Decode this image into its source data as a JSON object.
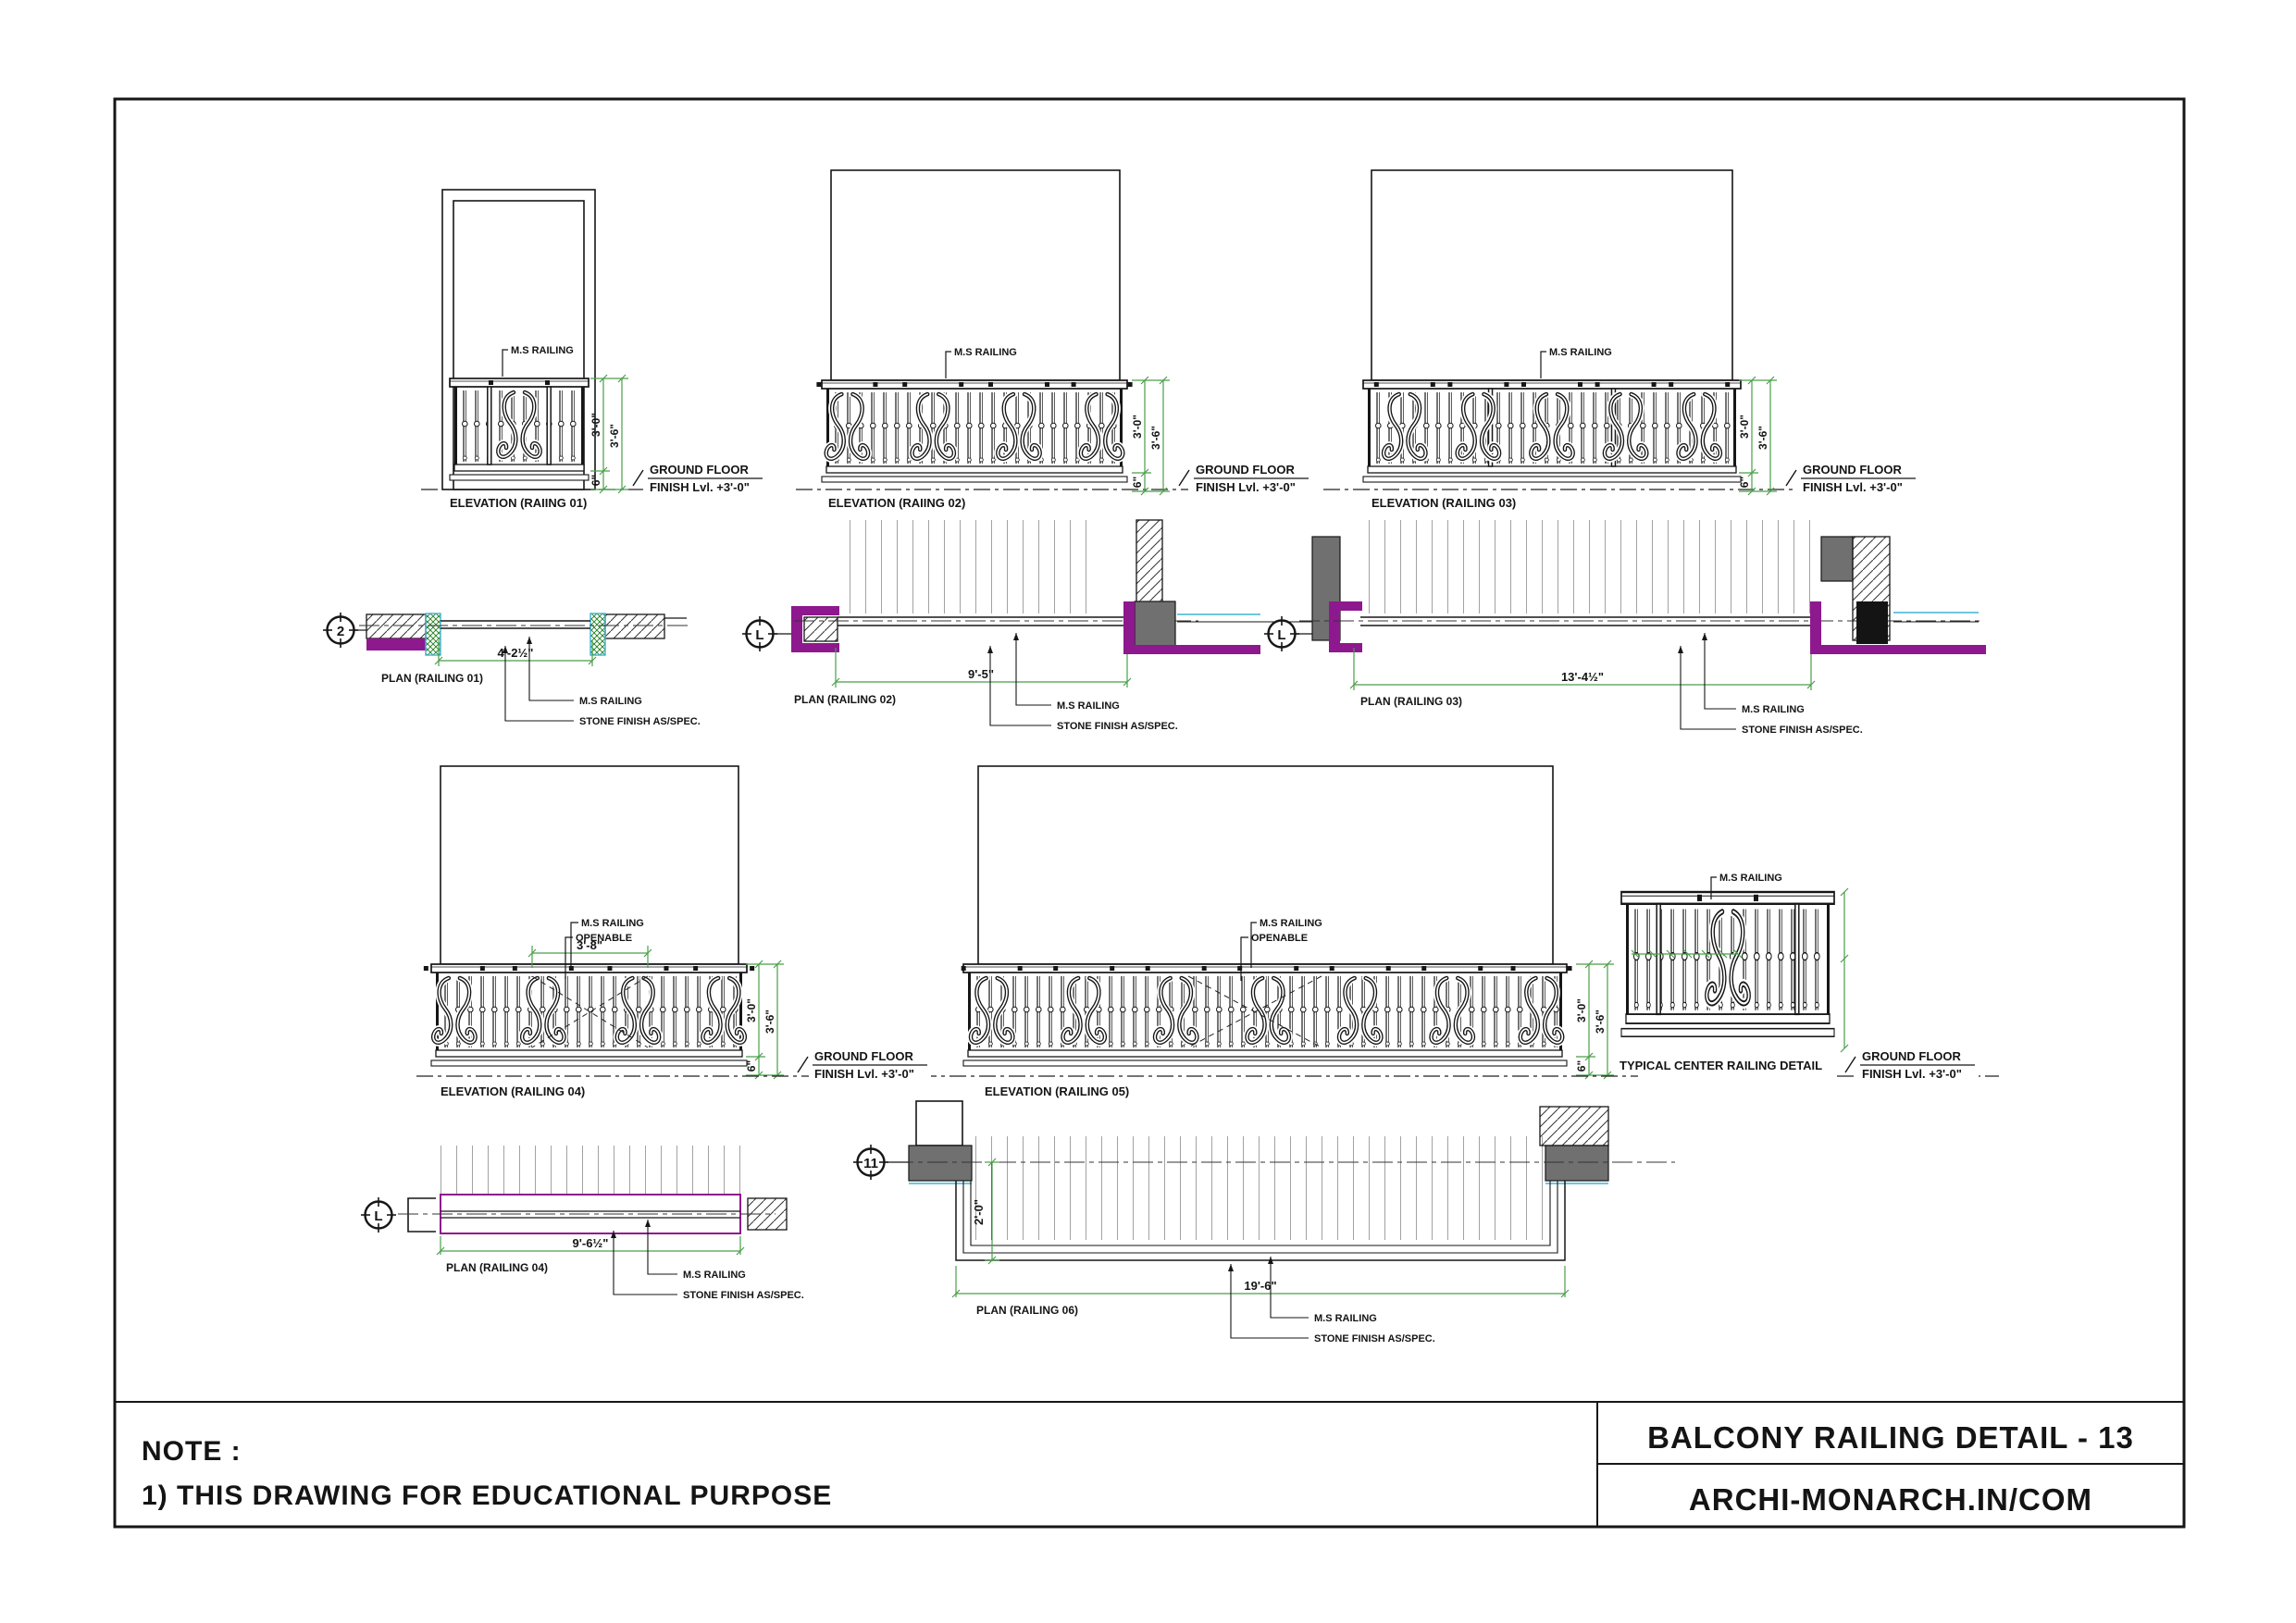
{
  "title_block": {
    "title": "BALCONY RAILING DETAIL - 13",
    "website": "ARCHI-MONARCH.IN/COM"
  },
  "note": {
    "heading": "NOTE :",
    "line1": "1) THIS DRAWING FOR EDUCATIONAL PURPOSE"
  },
  "labels": {
    "ms_railing": "M.S RAILING",
    "openable": "OPENABLE",
    "stone_finish": "STONE FINISH AS/SPEC.",
    "ground_floor": "GROUND FLOOR",
    "finish_lvl": "FINISH Lvl. +3'-0\""
  },
  "dims": {
    "rail_height": "3'-0\"",
    "total_height": "3'-6\"",
    "curb": "6\"",
    "openable_width": "3'-8\""
  },
  "elevations": [
    {
      "label": "ELEVATION (RAIING 01)"
    },
    {
      "label": "ELEVATION (RAIING 02)"
    },
    {
      "label": "ELEVATION (RAILING 03)"
    },
    {
      "label": "ELEVATION (RAILING 04)"
    },
    {
      "label": "ELEVATION (RAILING 05)"
    }
  ],
  "detail": {
    "label": "TYPICAL CENTER RAILING DETAIL"
  },
  "plans": [
    {
      "bubble": "2",
      "label": "PLAN (RAILING 01)",
      "dim": "4'-2½\""
    },
    {
      "bubble": "L",
      "label": "PLAN (RAILING 02)",
      "dim": "9'-5\""
    },
    {
      "bubble": "L",
      "label": "PLAN (RAILING 03)",
      "dim": "13'-4½\""
    },
    {
      "bubble": "L",
      "label": "PLAN (RAILING 04)",
      "dim": "9'-6½\""
    },
    {
      "bubble": "11",
      "label": "PLAN (RAILING 06)",
      "dim": "19'-6\"",
      "return_dim": "2'-0\""
    }
  ],
  "colors": {
    "dimension_green": "#4a9e4a",
    "wall_magenta": "#8e188e",
    "column_gray": "#707070",
    "accent_cyan": "#3fb3d4",
    "hatch_green": "#1e7e1e",
    "line_black": "#161616"
  }
}
